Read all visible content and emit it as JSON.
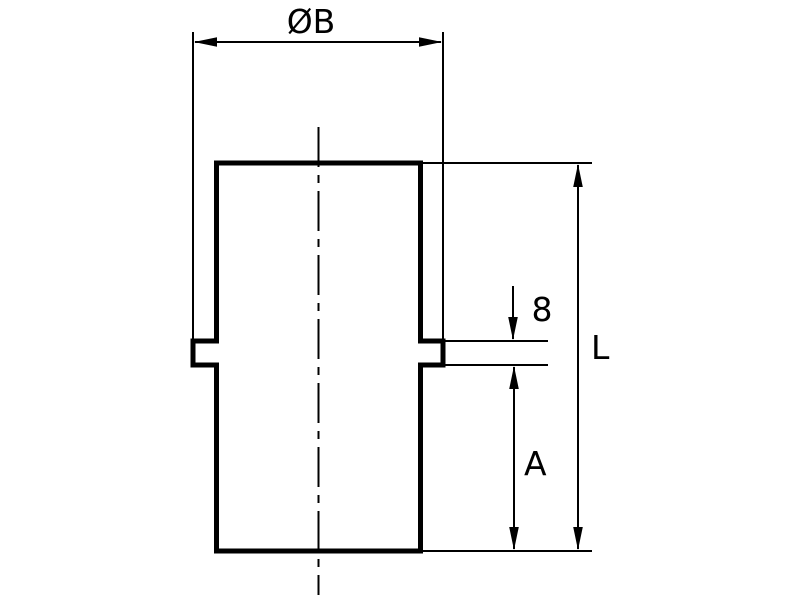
{
  "colors": {
    "line": "#000000",
    "background": "#ffffff"
  },
  "dimensions": {
    "diameter": {
      "label": "ØB"
    },
    "flange_thickness": {
      "label": "8"
    },
    "distance_a": {
      "label": "A"
    },
    "overall_length": {
      "label": "L"
    }
  }
}
